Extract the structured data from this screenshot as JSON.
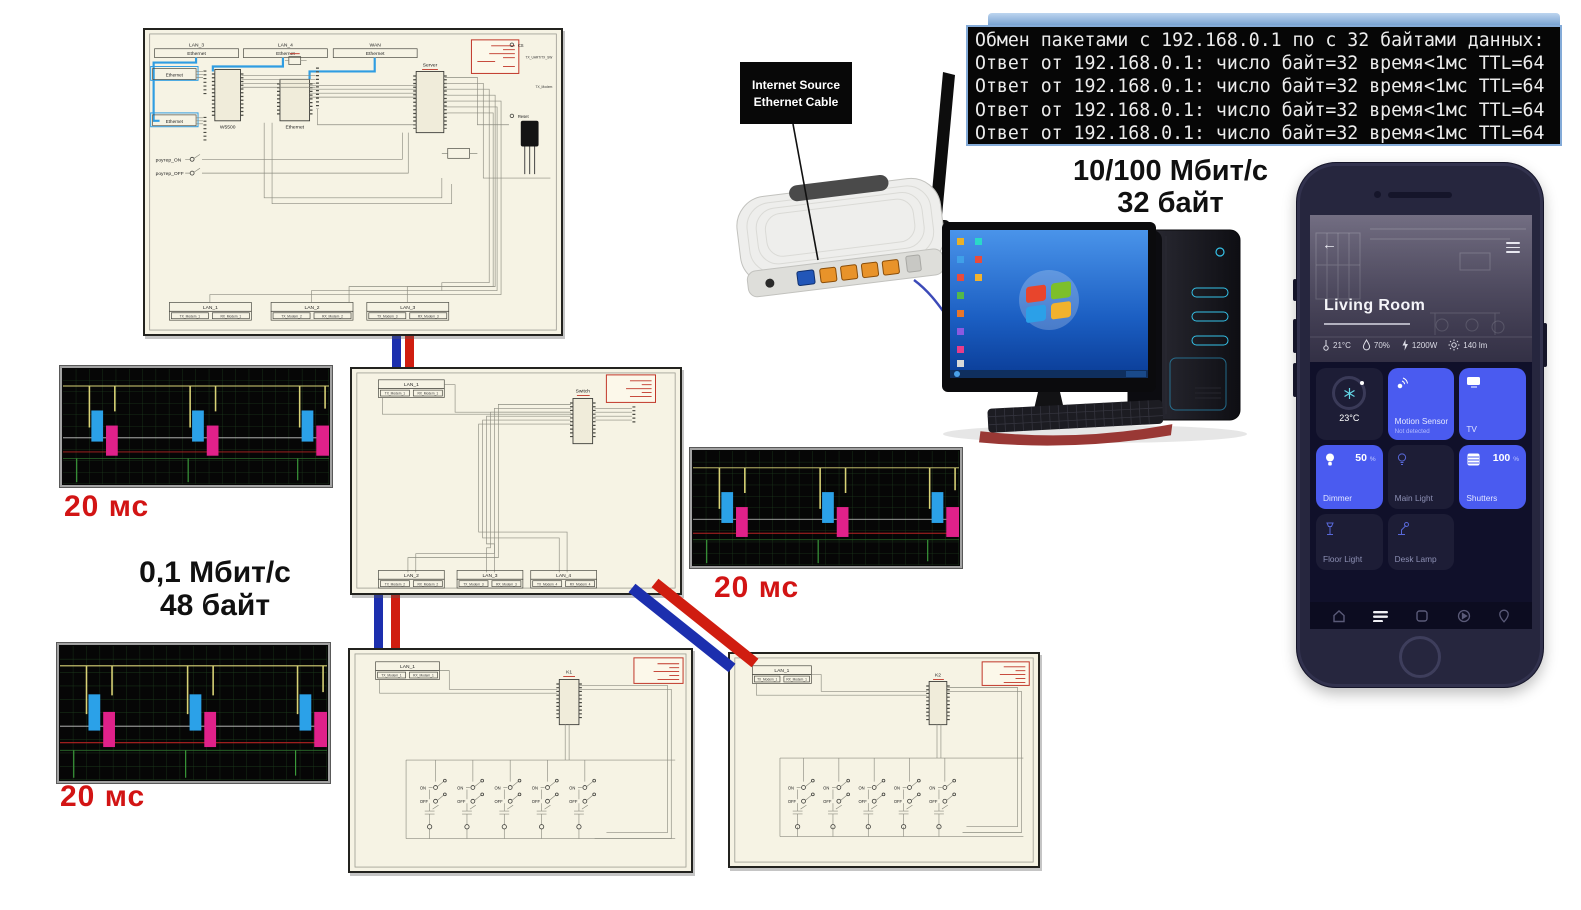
{
  "terminal": {
    "lines": [
      "Обмен пакетами с 192.168.0.1 по с 32 байтами данных:",
      "Ответ от 192.168.0.1: число байт=32 время<1мс TTL=64",
      "Ответ от 192.168.0.1: число байт=32 время<1мс TTL=64",
      "Ответ от 192.168.0.1: число байт=32 время<1мс TTL=64",
      "Ответ от 192.168.0.1: число байт=32 время<1мс TTL=64"
    ]
  },
  "callout": {
    "line1": "Internet Source",
    "line2": "Ethernet Cable"
  },
  "annotations": {
    "top_speed": "10/100 Мбит/с",
    "top_bytes": "32 байт",
    "mid_speed": "0,1 Мбит/с",
    "mid_bytes": "48 байт",
    "scope1_time": "20 мс",
    "scope2_time": "20 мс",
    "scope3_time": "20 мс"
  },
  "switches": {
    "on": "ON",
    "off": "OFF"
  },
  "schematic_top": {
    "net_headers": [
      {
        "name": "LAN_3",
        "port": "Ethernet"
      },
      {
        "name": "LAN_4",
        "port": "Ethernet"
      },
      {
        "name": "WAN",
        "port": "Ethernet"
      }
    ],
    "eth_left_top": "Ethernet",
    "eth_left_bottom": "Ethernet",
    "eth_mid": "Ethernet",
    "w5500": "W5500",
    "server": "Server",
    "router_on": "роутер_ON",
    "router_off": "роутер_OFF",
    "right_pins": [
      "CS",
      "TX_UART/TX_SW",
      "TX_Modem",
      "Reset"
    ],
    "bottom_nets": [
      {
        "name": "LAN_1",
        "tx": "TX_Modem_1",
        "rx": "RX_Modem_1"
      },
      {
        "name": "LAN_2",
        "tx": "TX_Modem_2",
        "rx": "RX_Modem_2"
      },
      {
        "name": "LAN_3",
        "tx": "TX_Modem_3",
        "rx": "RX_Modem_3"
      }
    ]
  },
  "schematic_mid": {
    "chip": "Switch",
    "top_net": {
      "name": "LAN_1",
      "tx": "TX_Modem_1",
      "rx": "RX_Modem_1"
    },
    "bottom_nets": [
      {
        "name": "LAN_2",
        "tx": "TX_Modem_2",
        "rx": "RX_Modem_2"
      },
      {
        "name": "LAN_3",
        "tx": "TX_Modem_3",
        "rx": "RX_Modem_3"
      },
      {
        "name": "LAN_4",
        "tx": "TX_Modem_4",
        "rx": "RX_Modem_4"
      }
    ]
  },
  "schematic_bl": {
    "chip": "K1",
    "top_net": {
      "name": "LAN_1",
      "tx": "TX_Modem_1",
      "rx": "RX_Modem_1"
    }
  },
  "schematic_br": {
    "chip": "K2",
    "top_net": {
      "name": "LAN_1",
      "tx": "TX_Modem_1",
      "rx": "RX_Modem_1"
    }
  },
  "phone": {
    "room_title": "Living Room",
    "stats": [
      {
        "icon": "thermometer-icon",
        "value": "21°C"
      },
      {
        "icon": "humidity-icon",
        "value": "70%"
      },
      {
        "icon": "power-icon",
        "value": "1200W"
      },
      {
        "icon": "luminosity-icon",
        "value": "140 lm"
      }
    ],
    "thermostat": {
      "value": "23°C"
    },
    "tiles": {
      "motion": {
        "title": "Motion Sensor",
        "sub": "Not detected"
      },
      "tv": {
        "title": "TV"
      },
      "dimmer": {
        "title": "Dimmer",
        "value": "50",
        "unit": "%"
      },
      "main_light": {
        "title": "Main Light"
      },
      "shutters": {
        "title": "Shutters",
        "value": "100",
        "unit": "%"
      },
      "floor_light": {
        "title": "Floor Light"
      },
      "desk_lamp": {
        "title": "Desk Lamp"
      }
    }
  }
}
